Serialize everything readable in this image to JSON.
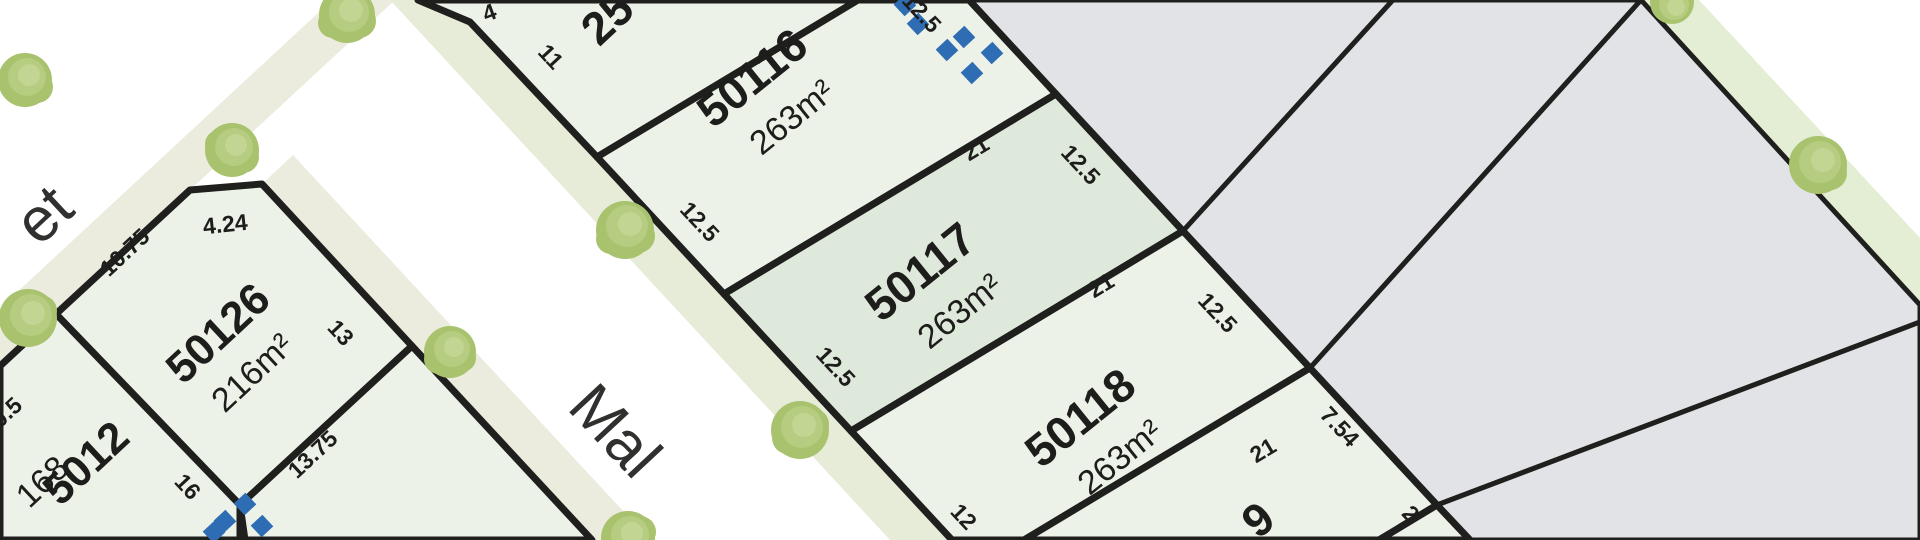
{
  "map_title": "Subdivision lot plan",
  "streets": {
    "street_left_partial": "et",
    "street_main_partial": "Mal"
  },
  "lots": [
    {
      "key": "lot-25-partial",
      "number": "25",
      "area": "",
      "status": "available"
    },
    {
      "key": "lot-50116",
      "number": "50116",
      "area": "263m²",
      "status": "available"
    },
    {
      "key": "lot-50117",
      "number": "50117",
      "area": "263m²",
      "status": "highlighted"
    },
    {
      "key": "lot-50118",
      "number": "50118",
      "area": "263m²",
      "status": "available"
    },
    {
      "key": "lot-50119-partial",
      "number": "9",
      "area": "",
      "status": "available"
    },
    {
      "key": "lot-50126",
      "number": "50126",
      "area": "216m²",
      "status": "available"
    },
    {
      "key": "lot-5012x-partial",
      "number": "5012",
      "area": "168",
      "status": "available"
    }
  ],
  "dimensions": [
    "4",
    "11",
    "12.5",
    "21",
    "12.5",
    "12.5",
    "21",
    "12",
    "12.5",
    "21",
    "7.54",
    "2",
    "4.24",
    "10.75",
    "13",
    "13.75",
    "16",
    "0.5"
  ],
  "colors": {
    "lot_fill": "#edf2e9",
    "lot_highlight_fill": "#dfe9db",
    "sold_lot_fill": "#e2e3e7",
    "boundary": "#1f1f1d",
    "verge_green": "#e7ecd8",
    "verge_beige": "#ebecde",
    "tree_green": "#a9c26e",
    "easement_blue": "#2e6db4"
  }
}
